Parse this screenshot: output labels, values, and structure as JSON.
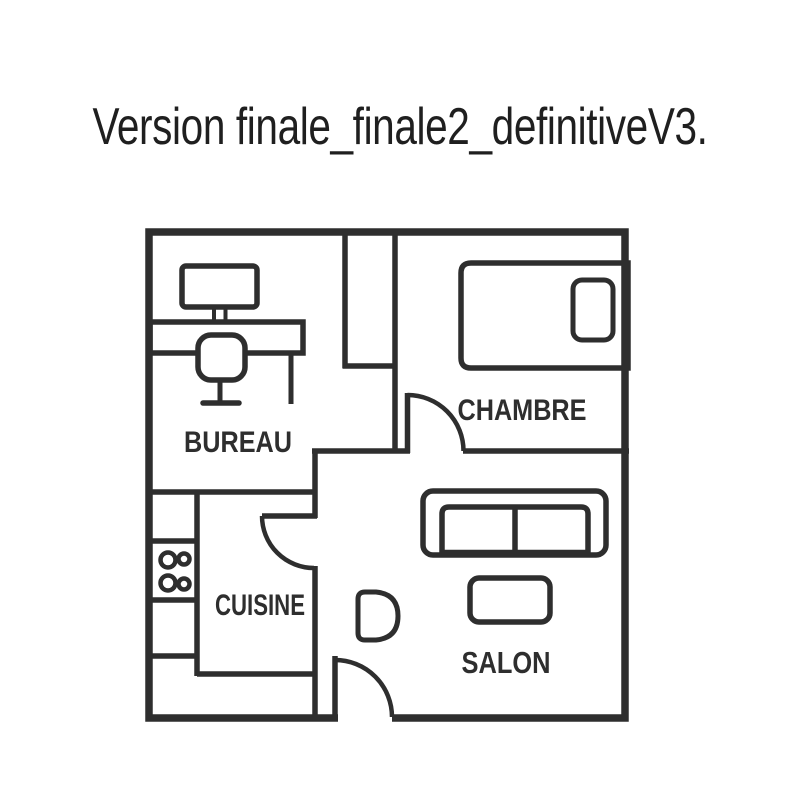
{
  "title": "Version finale_finale2_definitiveV3.",
  "colors": {
    "line": "#2e2e2e",
    "background": "#ffffff",
    "label_text": "#2e2e2e",
    "title_text": "#1f1f1f"
  },
  "floorplan": {
    "rooms": [
      {
        "id": "bureau",
        "label": "BUREAU"
      },
      {
        "id": "chambre",
        "label": "CHAMBRE"
      },
      {
        "id": "cuisine",
        "label": "CUISINE"
      },
      {
        "id": "salon",
        "label": "SALON"
      }
    ],
    "doors": [
      {
        "id": "chambre-door"
      },
      {
        "id": "cuisine-door"
      },
      {
        "id": "entry-door"
      }
    ],
    "furniture": [
      {
        "id": "desk"
      },
      {
        "id": "computer-monitor"
      },
      {
        "id": "office-chair"
      },
      {
        "id": "bed"
      },
      {
        "id": "pillow"
      },
      {
        "id": "kitchen-counter"
      },
      {
        "id": "stove-burners"
      },
      {
        "id": "sofa"
      },
      {
        "id": "coffee-table"
      },
      {
        "id": "armchair"
      }
    ]
  }
}
